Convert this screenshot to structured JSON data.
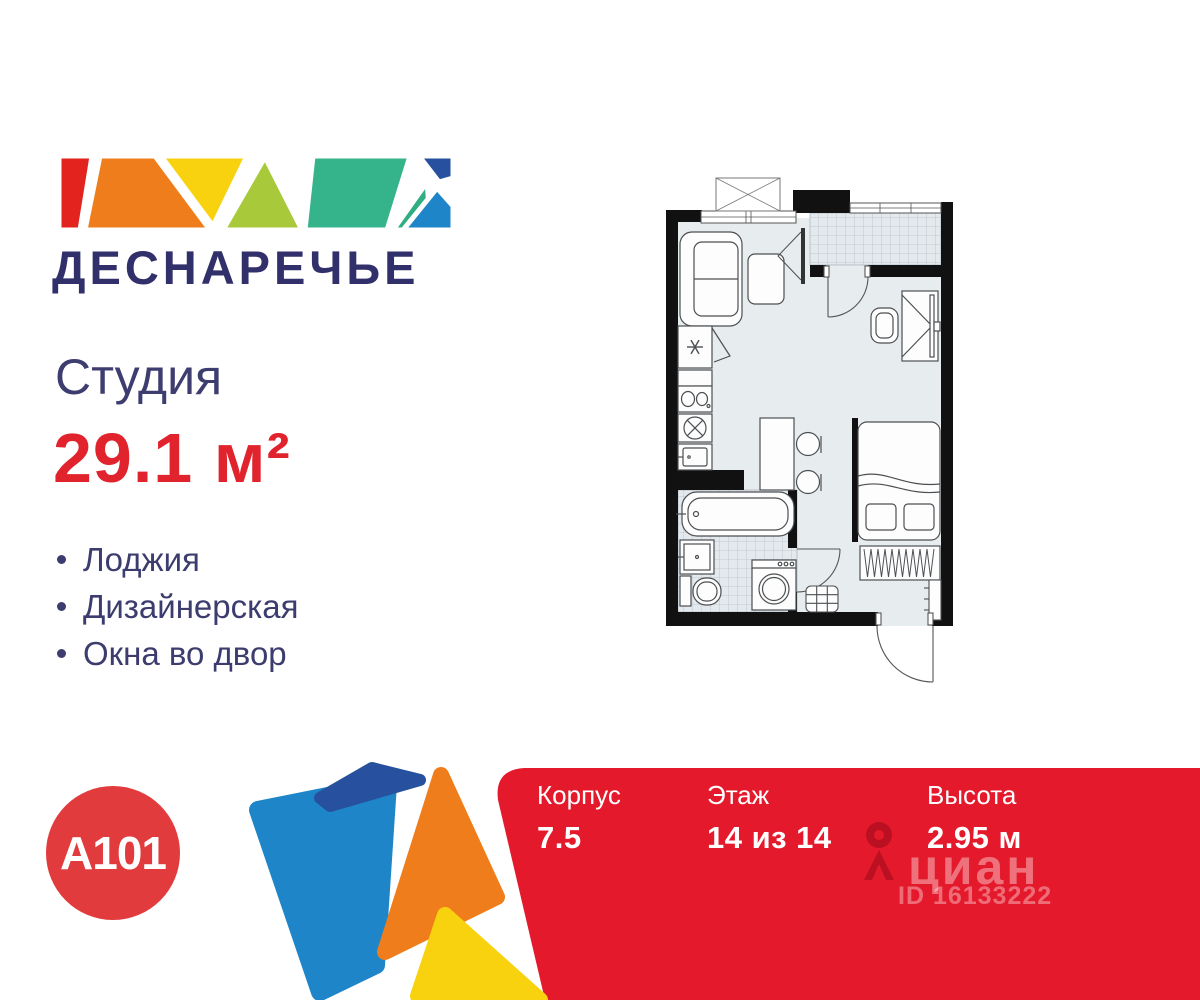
{
  "brand": {
    "complex_name": "ДЕСНАРЕЧЬЕ",
    "developer": "А101"
  },
  "listing": {
    "type_label": "Студия",
    "area_label": "29.1 м²",
    "features": [
      "Лоджия",
      "Дизайнерская",
      "Окна во двор"
    ]
  },
  "banner": {
    "stats": [
      {
        "label": "Корпус",
        "value": "7.5"
      },
      {
        "label": "Этаж",
        "value": "14 из 14"
      },
      {
        "label": "Высота",
        "value": "2.95 м"
      }
    ]
  },
  "watermark": {
    "site": "циан",
    "listing_id": "ID 16133222"
  },
  "floorplan": {
    "type": "studio-floor-plan",
    "elements": [
      "window",
      "ac-box",
      "sofa",
      "tv",
      "tv-stand",
      "refrigerator",
      "kitchen-sink",
      "stove",
      "kitchen-cabinet",
      "dining-table",
      "stools",
      "loggia",
      "loggia-door",
      "desk",
      "desk-chair",
      "bed",
      "wardrobe",
      "shelf",
      "bathtub",
      "bathroom-sink",
      "toilet",
      "washing-machine",
      "bathroom-door",
      "shoe-cabinet",
      "entrance-door"
    ]
  },
  "colors": {
    "navy_text": "#31306a",
    "red_accent": "#e0232c",
    "banner_red": "#e41a2c",
    "a101_red": "#e23b3e",
    "mosaic": [
      "#e2231e",
      "#ef7d1b",
      "#f8d20e",
      "#a8c93a",
      "#35b38b",
      "#2fae84",
      "#1e86c8",
      "#27519e"
    ],
    "plan_floor": "#e7ecef",
    "plan_wall": "#111111"
  }
}
